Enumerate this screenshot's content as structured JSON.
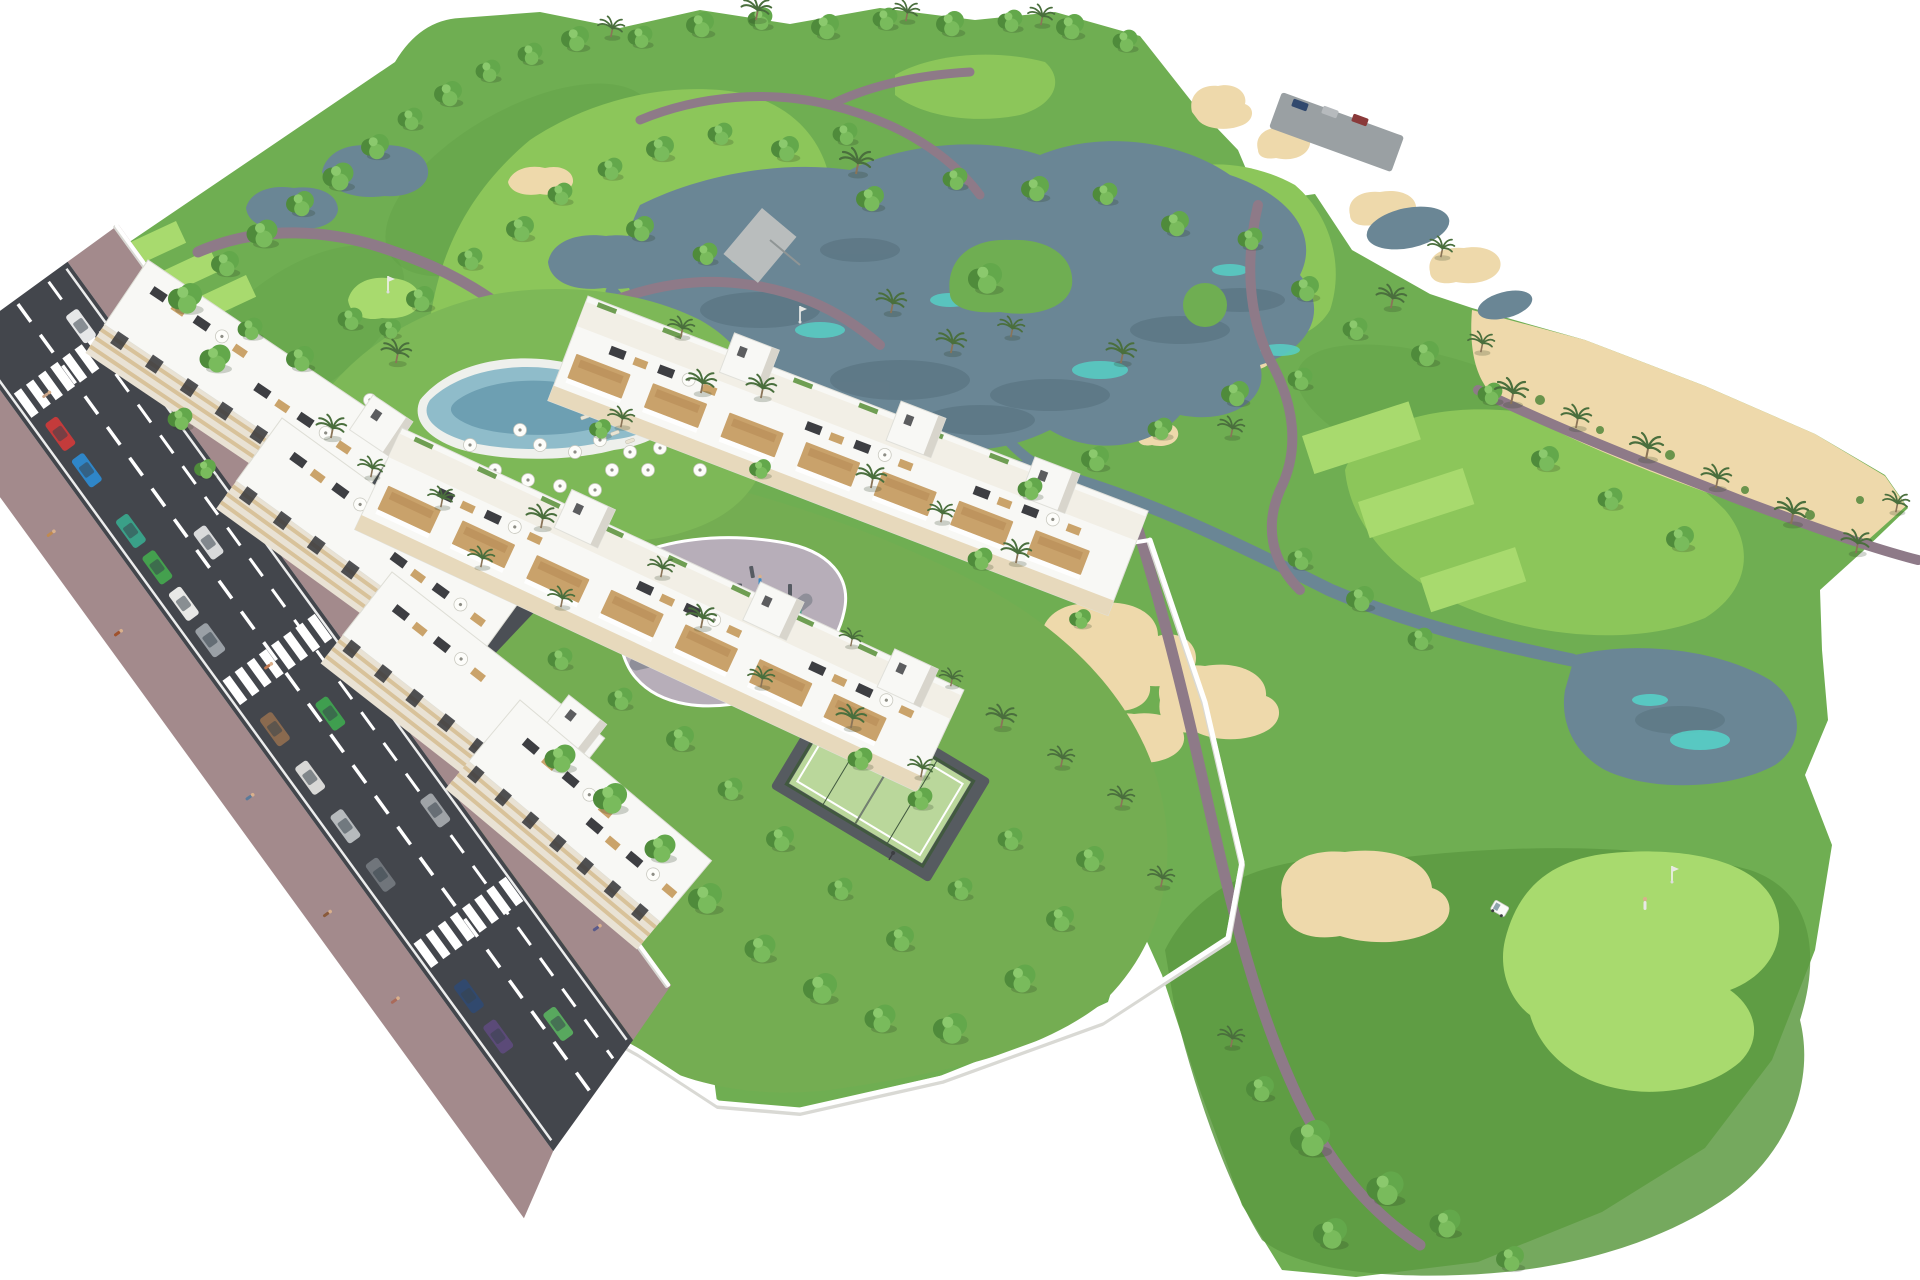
{
  "scene_label": "Aerial 3D architectural rendering of a golf resort residential development: white apartment and townhouse blocks with rooftop terraces beside a road with parked cars, a lagoon pool with parasols, playground, padel court and walled gardens, surrounded by a golf course with lakes, sand bunkers, cart paths, palm trees and a putting green with flag",
  "palette": {
    "bg": "#ffffff",
    "grassBase": "#6fae52",
    "grassDark": "#5d9a42",
    "fairway": "#8cc65a",
    "grassBright": "#a8da6e",
    "lawn": "#7db857",
    "garden": "#74ad52",
    "sand": "#eed9ab",
    "waterDeep": "#6a8695",
    "waterDark": "#55707c",
    "waterCyan": "#57cfc6",
    "path": "#8e7a88",
    "roadAsphalt": "#43464c",
    "roadDark": "#4b4f55",
    "sidewalk": "#a38a8c",
    "wallWhite": "#ffffff",
    "wallShadow": "#d9d9d4",
    "buildingWhite": "#f8f8f5",
    "buildingFace": "#e9e2d4",
    "creamBand": "#d8c29a",
    "windowDark": "#35363a",
    "wood": "#c9a26b",
    "roofDeck": "#3d3e42",
    "poolWater": "#8fbcca",
    "poolDeep": "#6d9fb2",
    "padelCourt": "#bad79b",
    "padelFence": "#41593f",
    "playground": "#b7aeb9",
    "playgroundPath": "#8f8f99"
  },
  "objects": {
    "trees": [
      [
        185,
        300,
        1.1
      ],
      [
        225,
        265,
        0.9
      ],
      [
        262,
        235,
        1.0
      ],
      [
        300,
        205,
        0.9
      ],
      [
        338,
        178,
        1.0
      ],
      [
        375,
        148,
        0.9
      ],
      [
        410,
        120,
        0.8
      ],
      [
        448,
        95,
        0.9
      ],
      [
        488,
        72,
        0.8
      ],
      [
        530,
        55,
        0.8
      ],
      [
        575,
        40,
        0.9
      ],
      [
        640,
        38,
        0.8
      ],
      [
        700,
        26,
        0.9
      ],
      [
        760,
        20,
        0.8
      ],
      [
        825,
        28,
        0.9
      ],
      [
        885,
        20,
        0.8
      ],
      [
        950,
        25,
        0.9
      ],
      [
        1010,
        22,
        0.8
      ],
      [
        1070,
        28,
        0.9
      ],
      [
        1125,
        42,
        0.8
      ],
      [
        215,
        360,
        1.0
      ],
      [
        250,
        330,
        0.8
      ],
      [
        300,
        360,
        0.9
      ],
      [
        350,
        320,
        0.8
      ],
      [
        420,
        300,
        0.9
      ],
      [
        470,
        260,
        0.8
      ],
      [
        520,
        230,
        0.9
      ],
      [
        560,
        195,
        0.8
      ],
      [
        610,
        170,
        0.8
      ],
      [
        660,
        150,
        0.9
      ],
      [
        720,
        135,
        0.8
      ],
      [
        785,
        150,
        0.9
      ],
      [
        845,
        135,
        0.8
      ],
      [
        640,
        230,
        0.9
      ],
      [
        705,
        255,
        0.8
      ],
      [
        870,
        200,
        0.9
      ],
      [
        955,
        180,
        0.8
      ],
      [
        1035,
        190,
        0.9
      ],
      [
        985,
        280,
        1.1
      ],
      [
        1105,
        195,
        0.8
      ],
      [
        1175,
        225,
        0.9
      ],
      [
        1250,
        240,
        0.8
      ],
      [
        1305,
        290,
        0.9
      ],
      [
        1355,
        330,
        0.8
      ],
      [
        1300,
        380,
        0.8
      ],
      [
        1235,
        395,
        0.9
      ],
      [
        1160,
        430,
        0.8
      ],
      [
        1095,
        460,
        0.9
      ],
      [
        1030,
        490,
        0.8
      ],
      [
        1425,
        355,
        0.9
      ],
      [
        1490,
        395,
        0.8
      ],
      [
        1545,
        460,
        0.9
      ],
      [
        1610,
        500,
        0.8
      ],
      [
        1680,
        540,
        0.9
      ],
      [
        1300,
        560,
        0.8
      ],
      [
        1360,
        600,
        0.9
      ],
      [
        1420,
        640,
        0.8
      ],
      [
        180,
        420,
        0.8
      ],
      [
        205,
        470,
        0.7
      ],
      [
        390,
        330,
        0.7
      ],
      [
        600,
        430,
        0.7
      ],
      [
        760,
        470,
        0.7
      ],
      [
        980,
        560,
        0.8
      ],
      [
        1080,
        620,
        0.7
      ],
      [
        560,
        760,
        1.0
      ],
      [
        610,
        800,
        1.1
      ],
      [
        660,
        850,
        1.0
      ],
      [
        705,
        900,
        1.1
      ],
      [
        760,
        950,
        1.0
      ],
      [
        820,
        990,
        1.1
      ],
      [
        880,
        1020,
        1.0
      ],
      [
        950,
        1030,
        1.1
      ],
      [
        1020,
        980,
        1.0
      ],
      [
        1060,
        920,
        0.9
      ],
      [
        1090,
        860,
        0.9
      ],
      [
        900,
        940,
        0.9
      ],
      [
        840,
        890,
        0.8
      ],
      [
        780,
        840,
        0.9
      ],
      [
        730,
        790,
        0.8
      ],
      [
        680,
        740,
        0.9
      ],
      [
        960,
        890,
        0.8
      ],
      [
        1010,
        840,
        0.8
      ],
      [
        860,
        760,
        0.8
      ],
      [
        920,
        800,
        0.8
      ],
      [
        620,
        700,
        0.8
      ],
      [
        560,
        660,
        0.8
      ],
      [
        1310,
        1140,
        1.3
      ],
      [
        1385,
        1190,
        1.2
      ],
      [
        1330,
        1235,
        1.1
      ],
      [
        1445,
        1225,
        1.0
      ],
      [
        1260,
        1090,
        0.9
      ],
      [
        1510,
        1260,
        0.9
      ]
    ],
    "palms": [
      [
        855,
        165,
        1.0
      ],
      [
        890,
        305,
        0.9
      ],
      [
        950,
        345,
        0.9
      ],
      [
        1010,
        330,
        0.8
      ],
      [
        1120,
        355,
        0.9
      ],
      [
        1230,
        430,
        0.8
      ],
      [
        1390,
        300,
        0.9
      ],
      [
        1440,
        250,
        0.8
      ],
      [
        700,
        385,
        0.9
      ],
      [
        620,
        420,
        0.8
      ],
      [
        870,
        480,
        0.9
      ],
      [
        940,
        515,
        0.8
      ],
      [
        1015,
        555,
        0.9
      ],
      [
        610,
        30,
        0.8
      ],
      [
        755,
        12,
        0.9
      ],
      [
        905,
        14,
        0.8
      ],
      [
        1040,
        18,
        0.8
      ],
      [
        1510,
        395,
        1.0
      ],
      [
        1575,
        420,
        0.9
      ],
      [
        1645,
        450,
        1.0
      ],
      [
        1715,
        480,
        0.9
      ],
      [
        1790,
        515,
        1.0
      ],
      [
        1855,
        545,
        0.9
      ],
      [
        1895,
        505,
        0.8
      ],
      [
        1480,
        345,
        0.8
      ],
      [
        330,
        430,
        0.9
      ],
      [
        370,
        470,
        0.8
      ],
      [
        540,
        520,
        0.9
      ],
      [
        660,
        570,
        0.8
      ],
      [
        700,
        620,
        0.9
      ],
      [
        760,
        680,
        0.8
      ],
      [
        850,
        720,
        0.9
      ],
      [
        920,
        770,
        0.8
      ],
      [
        1000,
        720,
        0.9
      ],
      [
        1060,
        760,
        0.8
      ],
      [
        560,
        600,
        0.8
      ],
      [
        480,
        560,
        0.8
      ],
      [
        850,
        640,
        0.7
      ],
      [
        950,
        680,
        0.7
      ],
      [
        1120,
        800,
        0.8
      ],
      [
        1160,
        880,
        0.8
      ],
      [
        440,
        500,
        0.8
      ],
      [
        395,
        355,
        0.9
      ],
      [
        680,
        330,
        0.8
      ],
      [
        760,
        390,
        0.9
      ],
      [
        1230,
        1040,
        0.8
      ]
    ],
    "parasols": [
      [
        388,
        430
      ],
      [
        405,
        462
      ],
      [
        425,
        492
      ],
      [
        450,
        472
      ],
      [
        448,
        510
      ],
      [
        480,
        500
      ],
      [
        470,
        445
      ],
      [
        495,
        470
      ],
      [
        510,
        505
      ],
      [
        528,
        480
      ],
      [
        545,
        508
      ],
      [
        560,
        486
      ],
      [
        578,
        508
      ],
      [
        595,
        490
      ],
      [
        612,
        470
      ],
      [
        600,
        440
      ],
      [
        630,
        452
      ],
      [
        648,
        470
      ],
      [
        660,
        448
      ],
      [
        575,
        452
      ],
      [
        540,
        445
      ],
      [
        520,
        430
      ],
      [
        370,
        400
      ],
      [
        355,
        420
      ],
      [
        690,
        430
      ],
      [
        700,
        470
      ]
    ],
    "sun_loungers": [
      [
        600,
        425,
        -20
      ],
      [
        615,
        433,
        -20
      ],
      [
        630,
        441,
        -20
      ],
      [
        585,
        417,
        -20
      ],
      [
        470,
        520,
        -20
      ],
      [
        485,
        528,
        -20
      ],
      [
        500,
        536,
        -20
      ],
      [
        515,
        544,
        -20
      ],
      [
        560,
        520,
        -20
      ],
      [
        575,
        528,
        -20
      ],
      [
        590,
        536,
        -20
      ]
    ],
    "parked_cars": [
      [
        135,
        "#c43b3b"
      ],
      [
        180,
        "#2f86c8"
      ],
      [
        255,
        "#3aa088"
      ],
      [
        300,
        "#44a04e"
      ],
      [
        345,
        "#e8e8e6"
      ],
      [
        390,
        "#9aa0a6"
      ],
      [
        500,
        "#8a6a4f"
      ],
      [
        560,
        "#d8d8d6"
      ],
      [
        620,
        "#b6babd"
      ],
      [
        680,
        "#70757b"
      ],
      [
        830,
        "#31496e"
      ],
      [
        880,
        "#5b4a78"
      ]
    ],
    "moving_cars": [
      [
        60,
        -38,
        "#e6e7e8"
      ],
      [
        310,
        -14,
        "#d9dadb"
      ],
      [
        520,
        -12,
        "#3f9e4f"
      ],
      [
        660,
        -40,
        "#9fa3a7"
      ],
      [
        905,
        -14,
        "#58a85e"
      ]
    ],
    "pedestrians": [
      [
        70,
        100,
        "#b2684a"
      ],
      [
        150,
        -100,
        "#7a5a8a"
      ],
      [
        210,
        108,
        "#c08a50"
      ],
      [
        260,
        -104,
        "#4a6a9a"
      ],
      [
        330,
        112,
        "#a0522d"
      ],
      [
        395,
        -90,
        "#8a4a4a"
      ],
      [
        445,
        10,
        "#c07850"
      ],
      [
        470,
        -95,
        "#7a6a50"
      ],
      [
        540,
        102,
        "#5a7a9a"
      ],
      [
        610,
        -98,
        "#b06a3a"
      ],
      [
        680,
        108,
        "#8a5a3a"
      ],
      [
        730,
        -88,
        "#6a8a5a"
      ],
      [
        790,
        104,
        "#aa6a5a"
      ],
      [
        850,
        -102,
        "#5a5a8a"
      ],
      [
        95,
        30,
        "#caa489"
      ]
    ],
    "playground_people": [
      [
        655,
        585,
        "#c2563c"
      ],
      [
        672,
        600,
        "#3c6ac2"
      ],
      [
        690,
        575,
        "#c2a23c"
      ],
      [
        705,
        615,
        "#50a05a"
      ],
      [
        720,
        590,
        "#b05a9a"
      ],
      [
        745,
        605,
        "#c2563c"
      ],
      [
        760,
        580,
        "#3c8ac2"
      ],
      [
        690,
        640,
        "#d08a4a"
      ],
      [
        730,
        655,
        "#5a5ac0"
      ],
      [
        775,
        635,
        "#c05a5a"
      ],
      [
        800,
        610,
        "#4aa08a"
      ],
      [
        650,
        630,
        "#a0703c"
      ]
    ],
    "playground_equipment": [
      [
        650,
        575,
        4,
        14,
        -20
      ],
      [
        668,
        590,
        12,
        3,
        10
      ],
      [
        688,
        570,
        4,
        12,
        0
      ],
      [
        702,
        585,
        10,
        3,
        -15
      ],
      [
        716,
        600,
        4,
        12,
        20
      ],
      [
        736,
        585,
        12,
        3,
        0
      ],
      [
        752,
        572,
        4,
        12,
        -10
      ],
      [
        770,
        598,
        10,
        3,
        15
      ],
      [
        690,
        625,
        14,
        3,
        0
      ],
      [
        715,
        638,
        4,
        12,
        -20
      ],
      [
        748,
        628,
        12,
        3,
        10
      ],
      [
        660,
        615,
        4,
        10,
        0
      ],
      [
        790,
        590,
        4,
        12,
        0
      ],
      [
        805,
        620,
        10,
        3,
        -10
      ]
    ],
    "top_parking_cars": [
      [
        1300,
        105,
        "#31496e"
      ],
      [
        1330,
        112,
        "#b6babd"
      ],
      [
        1360,
        120,
        "#8a3a3a"
      ]
    ]
  }
}
